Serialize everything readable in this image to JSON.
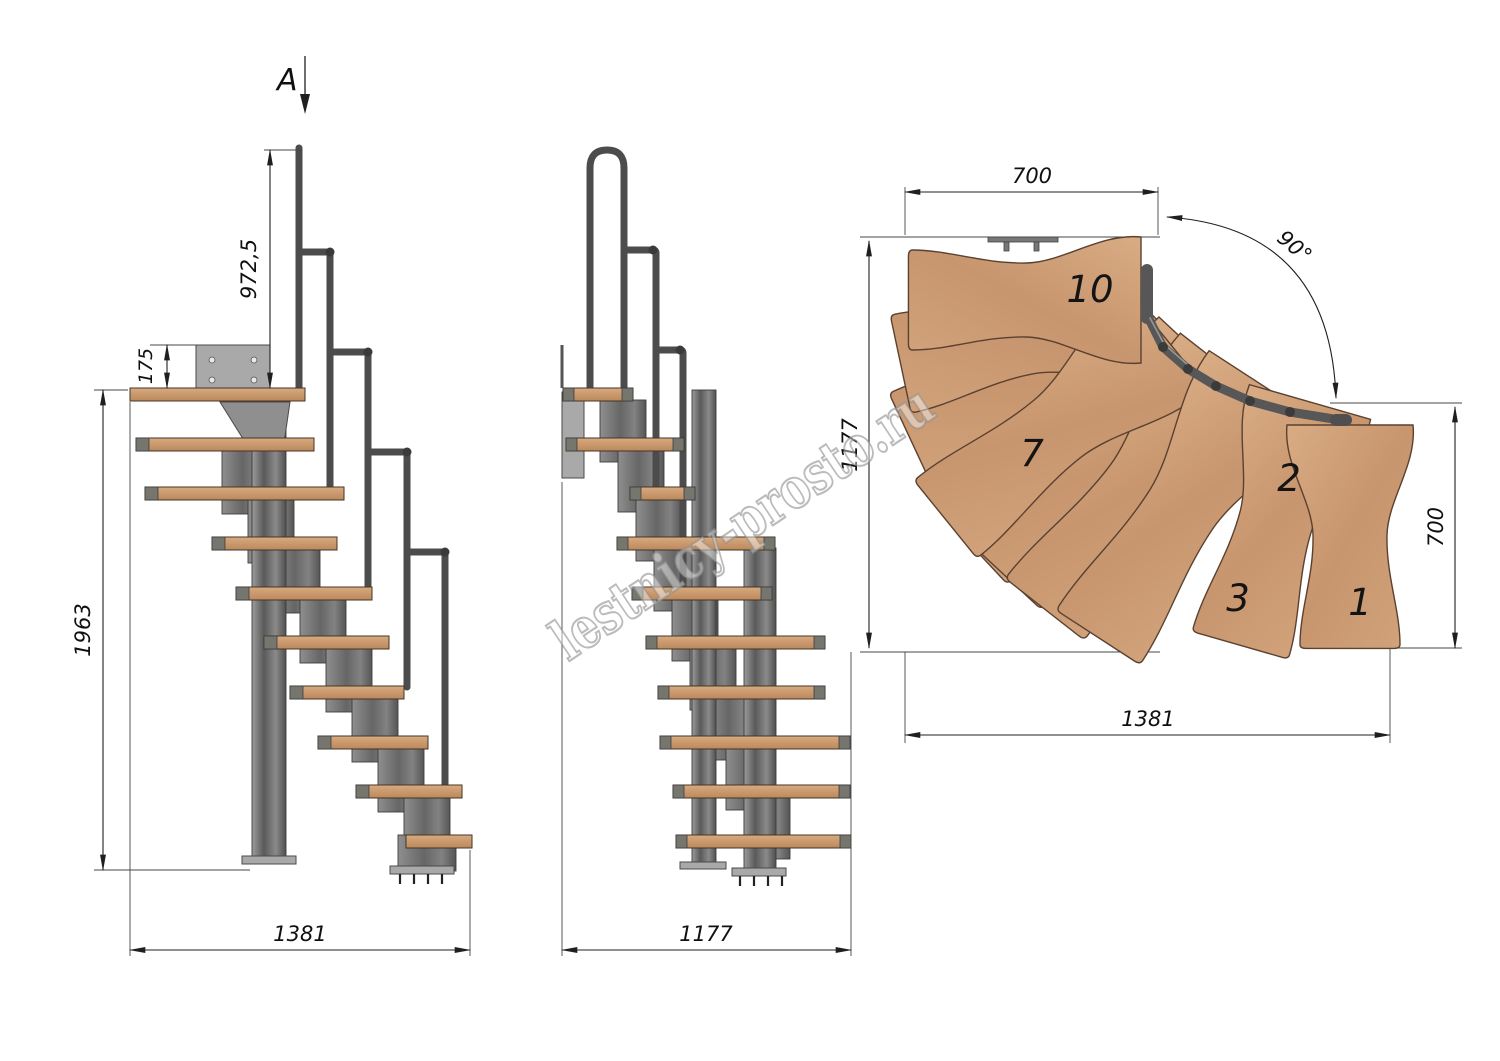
{
  "section_marker": "A",
  "side": {
    "rail_height": "972,5",
    "plate_offset": "175",
    "total_height": "1963",
    "total_run": "1381"
  },
  "front": {
    "total_width": "1177"
  },
  "plan": {
    "top_width": "700",
    "left_depth": "1177",
    "angle": "90°",
    "right_depth": "700",
    "bottom_width": "1381",
    "treads": {
      "t10": "10",
      "t7": "7",
      "t3": "3",
      "t2": "2",
      "t1": "1"
    }
  },
  "watermark": "lestnicy-prosto.ru",
  "colors": {
    "wood": "#cfa077",
    "wood_dark": "#bf8d60",
    "steel": "#6f6f6f",
    "rail": "#4c4c4c",
    "line": "#222222",
    "watermark_outline": "#8d8d8d"
  }
}
